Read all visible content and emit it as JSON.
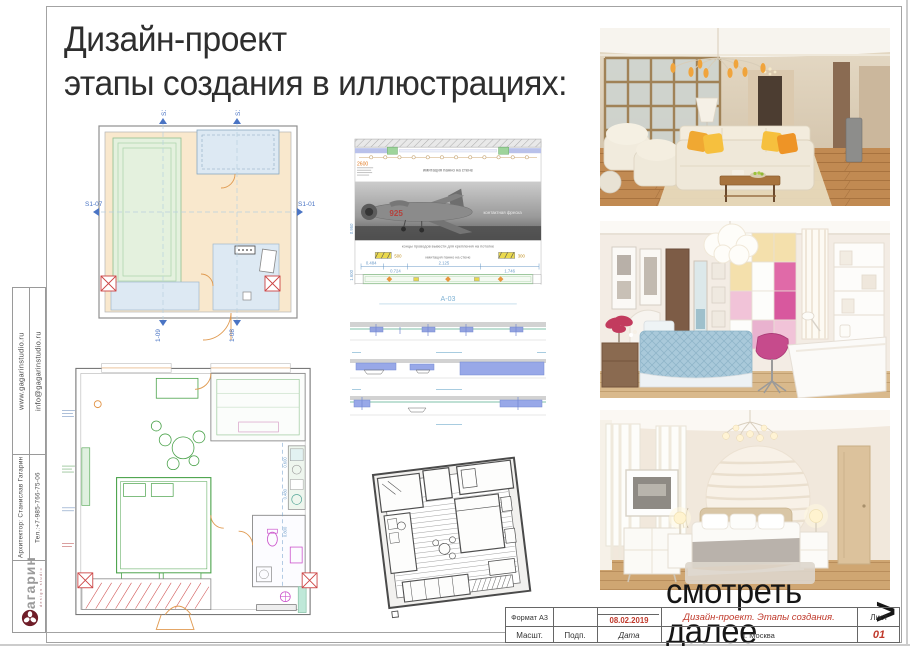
{
  "header": {
    "title_line1": "Дизайн-проект",
    "title_line2": "этапы создания в иллюстрациях:"
  },
  "sidebar": {
    "website": "www.gagarinstudio.ru",
    "email": "info@gagarinstudio.ru",
    "architect": "Архитектор: Станислав Гагарин",
    "phone": "Тел.:+7-985-766-75-06",
    "logo_text": "гагарин",
    "logo_tagline": "design studio",
    "logo_color": "#6f1d28"
  },
  "ceiling_plan": {
    "markers": {
      "top_left": "S1-09",
      "top_right": "S1-08",
      "left": "S1-07",
      "right": "S1-01",
      "bottom_left": "S1-09",
      "bottom_right": "S1-08"
    }
  },
  "elevation": {
    "caption": "А-03",
    "height_note": "2600",
    "plane_number": "925",
    "note_wall_top": "имитация панно на стене",
    "note_fresco": "контактная фреска",
    "note_wires": "концы проводов вывести для крепления на потолке",
    "note_wall_bottom": "имитация панно на стене",
    "dim_1": "0.484",
    "dim_2": "0.724",
    "dim_3": "2.125",
    "dim_4": "1.746",
    "block_dim_1": "500",
    "block_dim_2": "300",
    "vdim_1": "0.950",
    "vdim_2": "1.600"
  },
  "furniture_plan": {
    "dim_right_1": "0.600",
    "dim_right_2": "0.480",
    "dim_right_3": "0.800"
  },
  "see_more": {
    "label": "смотреть далее",
    "arrow": ">"
  },
  "title_block": {
    "format": "Формат А3",
    "scale": "Масшт.",
    "sign": "Подп.",
    "date_label": "Дата",
    "date_value": "08.02.2019",
    "project_title": "Дизайн-проект. Этапы создания.",
    "city": "г. Москва",
    "sheet_label": "Лист",
    "sheet_number": "01",
    "accent_color": "#c0392b"
  }
}
